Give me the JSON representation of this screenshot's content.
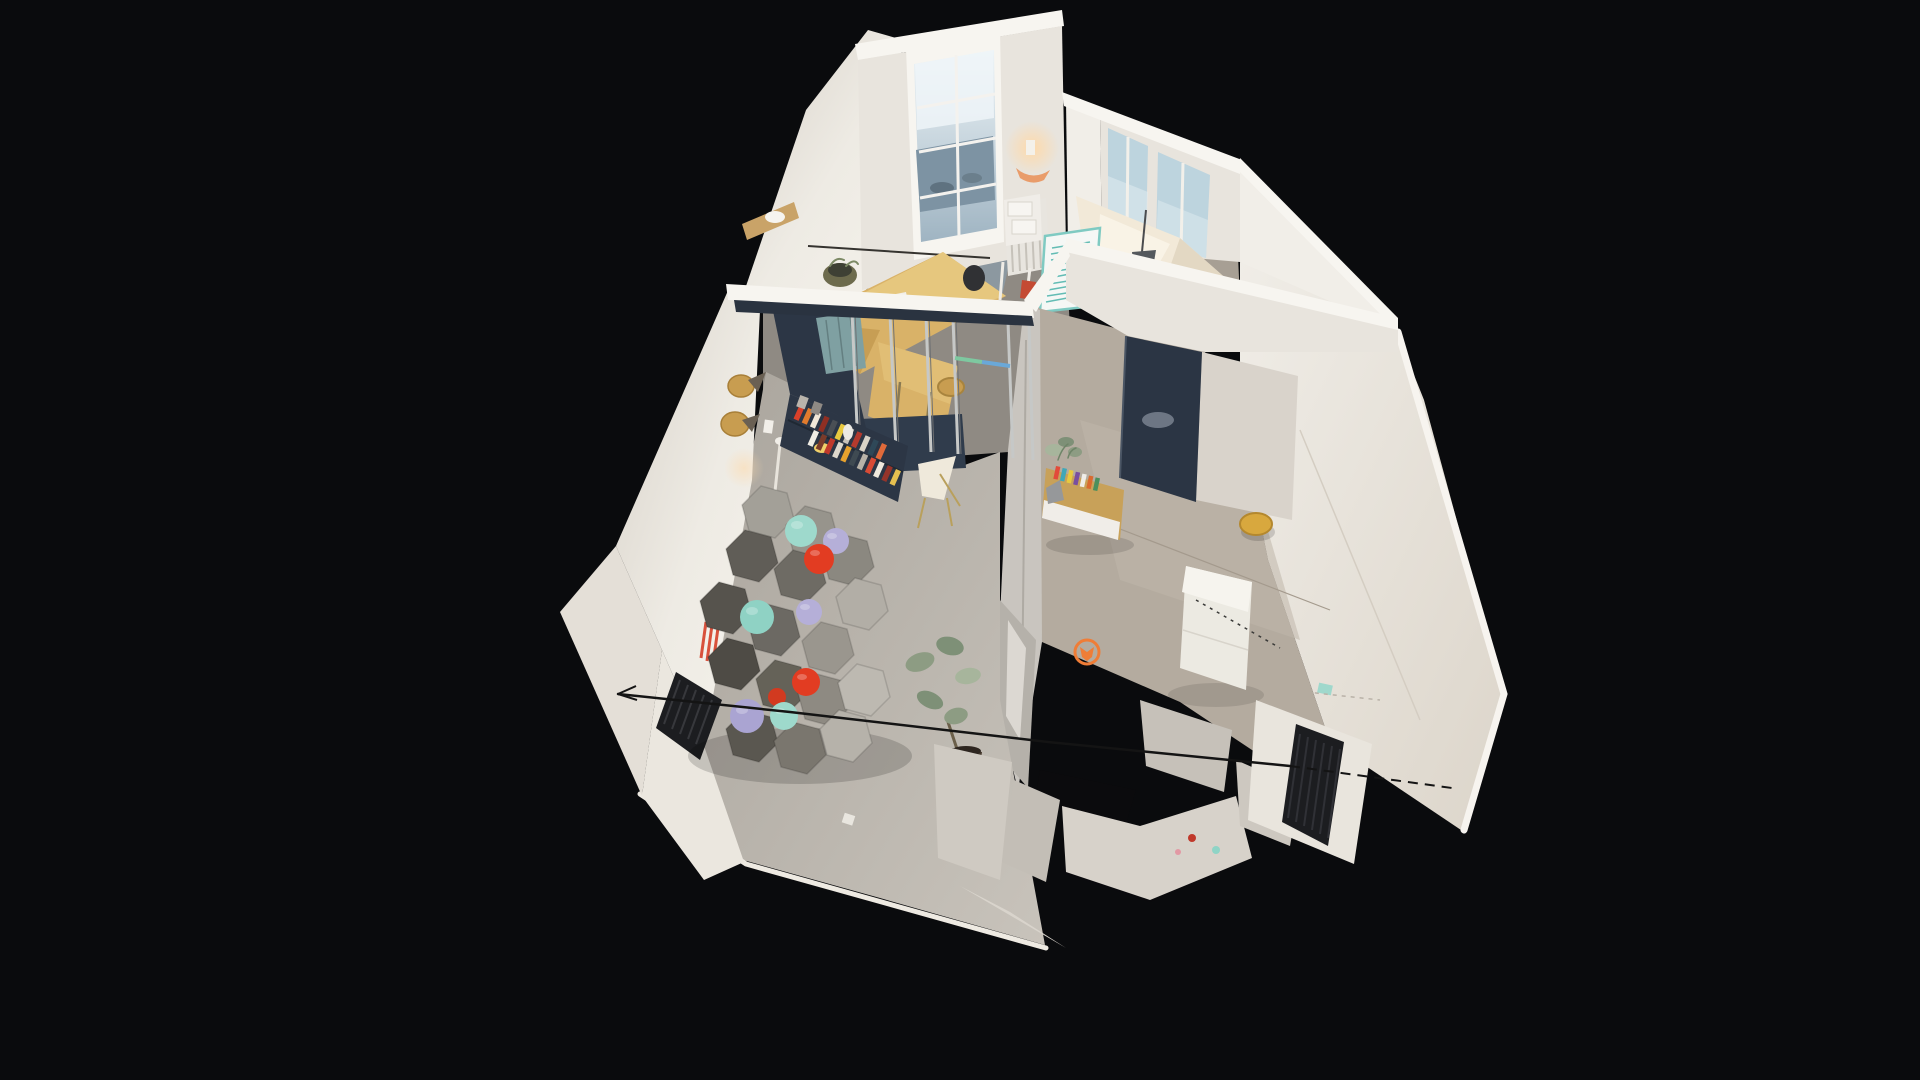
{
  "viewer": {
    "aria_label": "3D dollhouse view of a scanned apartment on a black canvas",
    "view_mode": "dollhouse"
  },
  "palette": {
    "bg": "#0a0b0d",
    "wallLit": "#f1eee8",
    "wall": "#e8e4dd",
    "wallShade": "#d9d3cb",
    "wallCut": "#f7f5f0",
    "wallOutside": "#e4dfd7",
    "floorOffice": "#8f8a83",
    "floorLiving": "#bab5ad",
    "floorKitchen": "#b4ab9f",
    "floorCorridor": "#a79f94",
    "plywood": "#d9b268",
    "plywoodLight": "#e6c77e",
    "plywoodDark": "#c79e54",
    "woodShelf": "#c9a368",
    "woodWarm": "#c89d50",
    "navy": "#2c3645",
    "navyPanel": "#303c4c",
    "navyDoor": "#2b3544",
    "metal": "#c6c8c7",
    "metalDark": "#6f7173",
    "glassStreet": "#7d93a3",
    "windowPale": "#bdd4de",
    "lace": "#e0ebf0",
    "bedding": "#f2e9d8",
    "beddingHi": "#f9f3e6",
    "whiteboard": "#f5f7f5",
    "tealInk": "#5fbab2",
    "tealFrame": "#7fcac2",
    "tealShade": "#7fa0a2",
    "mint": "#9ed9cc",
    "mintDeep": "#8fd2c4",
    "lavender": "#b5afd8",
    "lavenderDeep": "#aaa4d2",
    "red": "#e23c22",
    "redDeep": "#d23a20",
    "sofa1": "#a3a098",
    "sofa2": "#97948c",
    "sofa3": "#605d57",
    "sofa4": "#6e6b64",
    "sofa5": "#8b8880",
    "sofa6": "#b2aea6",
    "sofa7": "#56534d",
    "sofa8": "#6c6963",
    "sofa9": "#9a968e",
    "sofa10": "#4e4b45",
    "sofa11": "#656258",
    "sofa12": "#8e8a82",
    "sofa13": "#5a5750",
    "sofa14": "#7a766e",
    "sofa15": "#b6b2aa",
    "sofa16": "#bdb9b1",
    "radiator": "#1c1d20",
    "radiatorRib": "#37383c",
    "plantLight": "#a7b59c",
    "plant": "#8d9c83",
    "plantDeep": "#7e9077",
    "pot": "#463a2e",
    "stoolYellow": "#d8a83e",
    "marker": "#ef7d37",
    "posterRed": "#d8513c",
    "cable": "#141414",
    "debris": "#cfcac2",
    "debrisDark": "#c3beb6",
    "hole": "#0b0b0d",
    "islandSide": "#eceae2",
    "islandTop": "#f6f4ee",
    "sideboardWood": "#c8a159",
    "chairCream": "#efe9db",
    "matBlue": "#8c9aa6"
  },
  "scene": {
    "type": "dollhouse-3d-scan",
    "rooms": [
      "studio-office",
      "bedroom-nook",
      "living-area",
      "kitchen-hallway"
    ],
    "items": [
      "modular-hex-sofa",
      "ball-cushions",
      "navy-bookshelf",
      "glass-partition",
      "plywood-desk",
      "trestle-legs",
      "whiteboard",
      "navy-door",
      "kitchen-island",
      "yellow-stool",
      "wood-wall-lamps",
      "black-radiator",
      "white-radiator",
      "floor-plant",
      "sideboard-magazines",
      "orange-floor-marker",
      "ceiling-cable",
      "glazed-entry-door",
      "french-window",
      "bedding-drape",
      "scan-debris"
    ],
    "book_spine_colors": [
      "#d9402a",
      "#e07b2d",
      "#f2e8d8",
      "#8f2f23",
      "#4a4f55",
      "#e8c93f",
      "#c8c3bb",
      "#b33a2e",
      "#d9d3c7",
      "#2f4858",
      "#e06a3a",
      "#f0ede5",
      "#7a3b2a",
      "#c0392b",
      "#ded8cc",
      "#e8a22d",
      "#3f4a52",
      "#b8b2a8",
      "#d94b35",
      "#efe9dd",
      "#95342a",
      "#e5c050"
    ],
    "magazine_spine_colors": [
      "#e24b3a",
      "#3fa7b8",
      "#e8c93f",
      "#7a4fa0",
      "#f0ede8",
      "#d96a2f",
      "#4a8f5d"
    ]
  }
}
